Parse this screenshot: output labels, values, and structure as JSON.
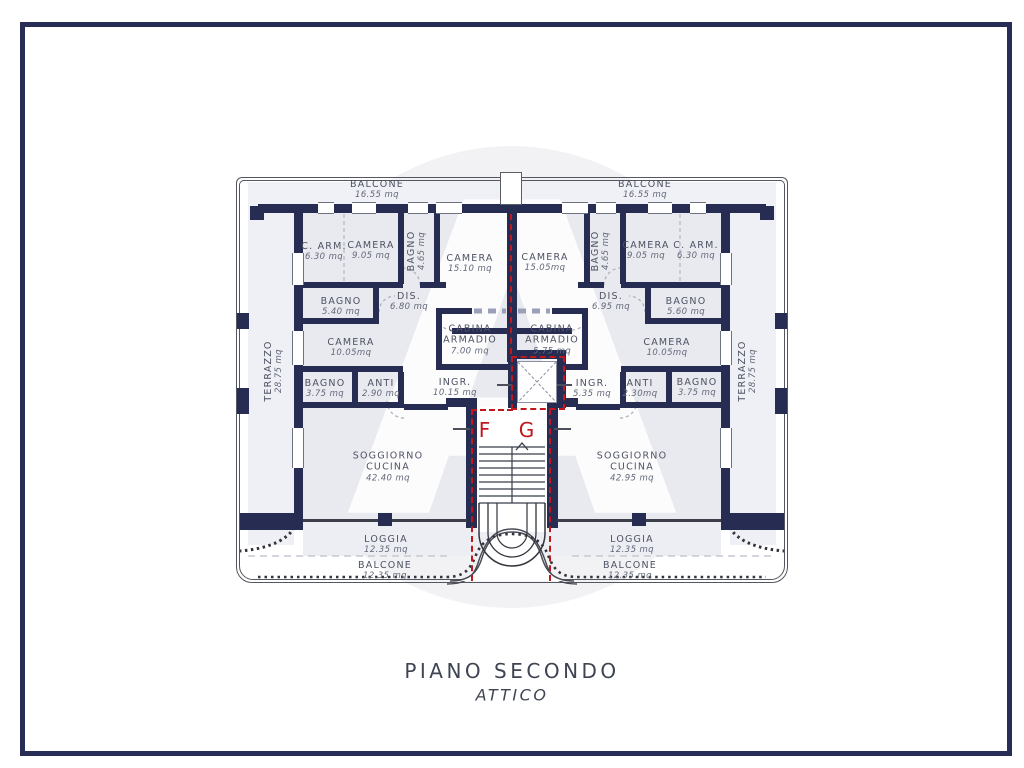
{
  "title": {
    "line1": "PIANO SECONDO",
    "line2": "ATTICO"
  },
  "watermark": {
    "letter": "A"
  },
  "markers": {
    "f": "F",
    "g": "G"
  },
  "colors": {
    "wall": "#272c52",
    "floor": "#e9eaef",
    "section_line": "#c0181c",
    "text": "#4d5263",
    "frame": "#282d55"
  },
  "rooms": [
    {
      "name": "C. ARM.",
      "area": "6.30 mq"
    },
    {
      "name": "CAMERA",
      "area": "9.05 mq"
    },
    {
      "name": "BAGNO",
      "area": "4.65 mq"
    },
    {
      "name": "CAMERA",
      "area": "15.10 mq"
    },
    {
      "name": "BAGNO",
      "area": "5.40 mq"
    },
    {
      "name": "DIS.",
      "area": "6.80 mq"
    },
    {
      "name": "CAMERA",
      "area": "10.05mq"
    },
    {
      "name": "CABINA ARMADIO",
      "area": "7.00 mq"
    },
    {
      "name": "BAGNO",
      "area": "3.75 mq"
    },
    {
      "name": "ANTI",
      "area": "2.90 mq"
    },
    {
      "name": "INGR.",
      "area": "10.15 mq"
    },
    {
      "name": "SOGGIORNO CUCINA",
      "area": "42.40 mq"
    },
    {
      "name": "CAMERA",
      "area": "15.05mq"
    },
    {
      "name": "BAGNO",
      "area": "4.65 mq"
    },
    {
      "name": "CAMERA",
      "area": "9.05 mq"
    },
    {
      "name": "C. ARM.",
      "area": "6.30 mq"
    },
    {
      "name": "DIS.",
      "area": "6.95 mq"
    },
    {
      "name": "BAGNO",
      "area": "5.60 mq"
    },
    {
      "name": "CAMERA",
      "area": "10.05mq"
    },
    {
      "name": "CABINA ARMADIO",
      "area": "5.75 mq"
    },
    {
      "name": "INGR.",
      "area": "5.35 mq"
    },
    {
      "name": "ANTI",
      "area": "2.30mq"
    },
    {
      "name": "BAGNO",
      "area": "3.75 mq"
    },
    {
      "name": "SOGGIORNO CUCINA",
      "area": "42.95 mq"
    },
    {
      "name": "TERRAZZO",
      "area": "28.75 mq"
    },
    {
      "name": "TERRAZZO",
      "area": "28.75 mq"
    },
    {
      "name": "BALCONE",
      "area": "16.55 mq"
    },
    {
      "name": "BALCONE",
      "area": "16.55 mq"
    },
    {
      "name": "LOGGIA",
      "area": "12.35 mq"
    },
    {
      "name": "LOGGIA",
      "area": "12.35 mq"
    },
    {
      "name": "BALCONE",
      "area": "12.35 mq"
    },
    {
      "name": "BALCONE",
      "area": "12.35 mq"
    }
  ]
}
